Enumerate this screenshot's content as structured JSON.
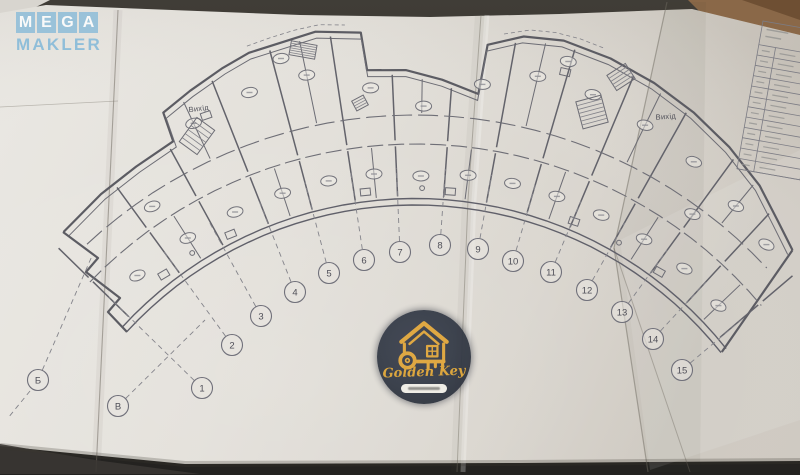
{
  "watermark_mega": {
    "letters": [
      "M",
      "E",
      "G",
      "A"
    ],
    "word": "MAKLER",
    "color": "#7eb6d8"
  },
  "watermark_golden_key": {
    "brand": "Golden Key",
    "gold_color": "#dfa843",
    "circle_color": "#343a46"
  },
  "plan": {
    "exit_label_left": "Вихід",
    "exit_label_right": "Вихід",
    "center": [
      415,
      596
    ],
    "inner_radii": [
      391,
      397.5
    ],
    "inner_range": [
      -47.5,
      51.5
    ],
    "outer_profile": [
      [
        -44,
        506
      ],
      [
        -38,
        510
      ],
      [
        -33,
        512
      ],
      [
        -28,
        515
      ],
      [
        -27.5,
        545
      ],
      [
        -24,
        553
      ],
      [
        -20,
        562
      ],
      [
        -17,
        568
      ],
      [
        -10,
        573
      ],
      [
        -5.5,
        566
      ],
      [
        -5.2,
        528
      ],
      [
        -1,
        526
      ],
      [
        3,
        517
      ],
      [
        7.2,
        506
      ],
      [
        7.5,
        556
      ],
      [
        11,
        570
      ],
      [
        15,
        575
      ],
      [
        20,
        572
      ],
      [
        25,
        566
      ],
      [
        30,
        558
      ],
      [
        35,
        548
      ],
      [
        40,
        536
      ],
      [
        44,
        522
      ],
      [
        47.5,
        512
      ]
    ],
    "left_tip": [
      [
        63,
        232
      ],
      [
        98,
        258
      ],
      [
        86,
        272
      ],
      [
        120,
        298
      ],
      [
        108,
        312
      ],
      [
        127,
        332
      ]
    ],
    "right_end": {
      "outer": [
        47.5,
        512
      ],
      "inner": [
        51.5,
        392
      ]
    },
    "corridors": [
      {
        "r": 452,
        "a0": -46,
        "a1": 50,
        "dash": "16 5"
      },
      {
        "r": 481,
        "a0": -43,
        "a1": 47,
        "dash": "20 6"
      }
    ],
    "canopies": [
      {
        "a0": -17,
        "a1": -7,
        "off": 7
      },
      {
        "a0": 9,
        "a1": 19,
        "off": 7
      }
    ],
    "axis_angles": [
      -45.7,
      -36.1,
      -28.7,
      -21.5,
      -14.9,
      -8.6,
      -2.5,
      4.1,
      10.3,
      16.3,
      22.8,
      29.3,
      36.1,
      42.8,
      49.7
    ],
    "stub_angles": [
      -32.4,
      -18.2,
      -5.55,
      7.2,
      19.55,
      32.7,
      46.25
    ],
    "half_angles": [
      -25.1,
      -11.75,
      0.8,
      13.3,
      26.05,
      39.45
    ],
    "ovals": [
      [
        -40.9,
        424
      ],
      [
        -32.4,
        424
      ],
      [
        -25.1,
        424
      ],
      [
        -18.2,
        424
      ],
      [
        -11.75,
        424
      ],
      [
        -5.55,
        424
      ],
      [
        0.8,
        420
      ],
      [
        7.2,
        424
      ],
      [
        13.3,
        424
      ],
      [
        19.55,
        424
      ],
      [
        26.05,
        424
      ],
      [
        32.7,
        424
      ],
      [
        39.45,
        424
      ],
      [
        46.25,
        420
      ],
      [
        -25.1,
        522
      ],
      [
        -18.2,
        530
      ],
      [
        -11.75,
        532
      ],
      [
        -5,
        510
      ],
      [
        1,
        490
      ],
      [
        7.5,
        516
      ],
      [
        13.3,
        534
      ],
      [
        19.55,
        532
      ],
      [
        26.05,
        524
      ],
      [
        32.7,
        516
      ],
      [
        39.45,
        505
      ],
      [
        45,
        497
      ],
      [
        -14,
        554
      ],
      [
        16,
        556
      ],
      [
        -34,
        470
      ],
      [
        36,
        472
      ]
    ],
    "fixtures_rect": [
      [
        -38,
        408
      ],
      [
        -27,
        406
      ],
      [
        -7,
        407
      ],
      [
        5,
        406
      ],
      [
        23,
        407
      ],
      [
        37,
        406
      ],
      [
        -23.5,
        524
      ],
      [
        16,
        545
      ]
    ],
    "fixtures_circ": [
      [
        -33,
        409
      ],
      [
        1,
        408
      ],
      [
        30,
        408
      ]
    ],
    "stairs": [
      {
        "x": 197,
        "y": 136,
        "w": 22,
        "h": 30,
        "rot": 36,
        "n": 6
      },
      {
        "x": 303,
        "y": 50,
        "w": 26,
        "h": 14,
        "rot": 10,
        "n": 6
      },
      {
        "x": 592,
        "y": 112,
        "w": 26,
        "h": 28,
        "rot": -15,
        "n": 7
      },
      {
        "x": 621,
        "y": 77,
        "w": 22,
        "h": 18,
        "rot": -33,
        "n": 5
      },
      {
        "x": 360,
        "y": 103,
        "w": 13,
        "h": 11,
        "rot": -28,
        "n": 4
      }
    ],
    "axis_markers": [
      {
        "label": "Б",
        "x": 38,
        "y": 380,
        "tx": 92,
        "ty": 256
      },
      {
        "label": "В",
        "x": 118,
        "y": 406,
        "tx": 205,
        "ty": 320
      },
      {
        "label": "1",
        "x": 202,
        "y": 388
      },
      {
        "label": "2",
        "x": 232,
        "y": 345
      },
      {
        "label": "3",
        "x": 261,
        "y": 316
      },
      {
        "label": "4",
        "x": 295,
        "y": 292
      },
      {
        "label": "5",
        "x": 329,
        "y": 273
      },
      {
        "label": "6",
        "x": 364,
        "y": 260
      },
      {
        "label": "7",
        "x": 400,
        "y": 252
      },
      {
        "label": "8",
        "x": 440,
        "y": 245
      },
      {
        "label": "9",
        "x": 478,
        "y": 249
      },
      {
        "label": "10",
        "x": 513,
        "y": 261
      },
      {
        "label": "11",
        "x": 551,
        "y": 272
      },
      {
        "label": "12",
        "x": 587,
        "y": 290
      },
      {
        "label": "13",
        "x": 622,
        "y": 312
      },
      {
        "label": "14",
        "x": 653,
        "y": 339
      },
      {
        "label": "15",
        "x": 682,
        "y": 370
      }
    ]
  },
  "title_block": {
    "x": 763,
    "y": 21,
    "rot": 10,
    "w": 64,
    "h": 150,
    "col_x": 17,
    "top_h": 24,
    "rows": 12
  }
}
